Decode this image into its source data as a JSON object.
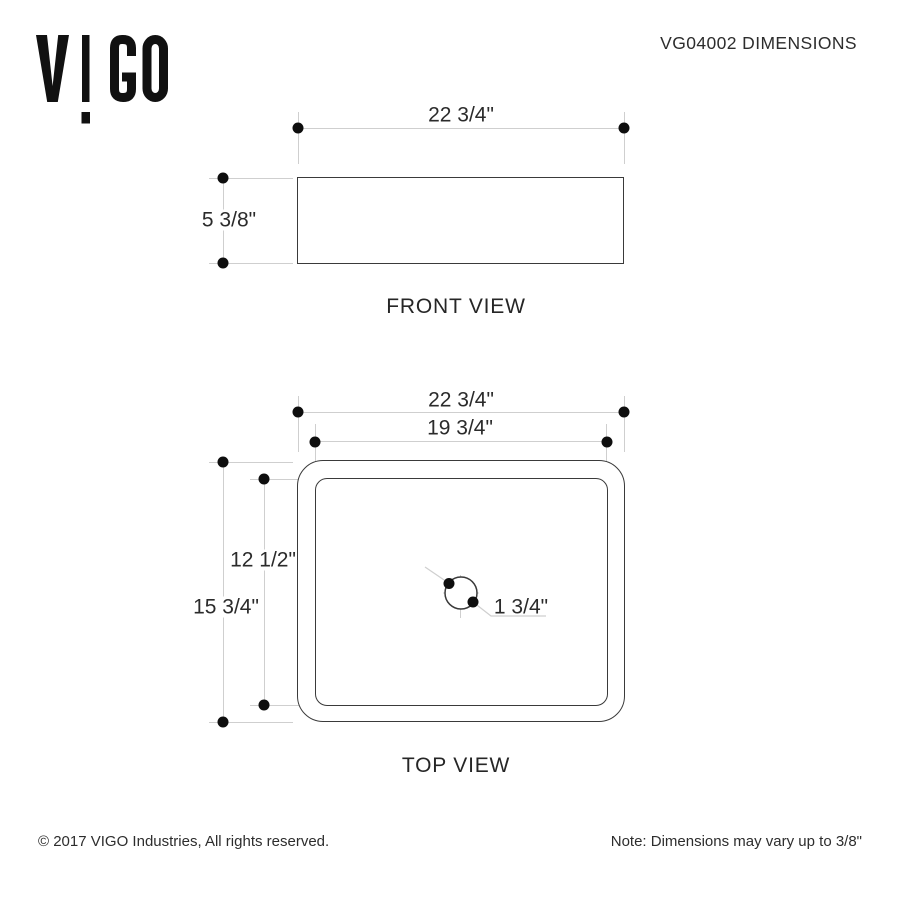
{
  "header": {
    "logo_text": "VIGO",
    "title": "VG04002 DIMENSIONS"
  },
  "front_view": {
    "caption": "FRONT VIEW",
    "width_dim": "22 3/4\"",
    "height_dim": "5 3/8\""
  },
  "top_view": {
    "caption": "TOP VIEW",
    "outer_width_dim": "22 3/4\"",
    "inner_width_dim": "19 3/4\"",
    "outer_depth_dim": "15 3/4\"",
    "inner_depth_dim": "12 1/2\"",
    "drain_dim": "1 3/4\""
  },
  "footer": {
    "copyright": "© 2017 VIGO Industries, All rights reserved.",
    "note": "Note: Dimensions may vary up to 3/8\""
  },
  "colors": {
    "outline_dark": "#3a3a3a",
    "dimension_line_light": "#cfcfcf",
    "endpoint_dot": "#0e0e0e",
    "text": "#2d2d2d",
    "background": "#ffffff"
  }
}
